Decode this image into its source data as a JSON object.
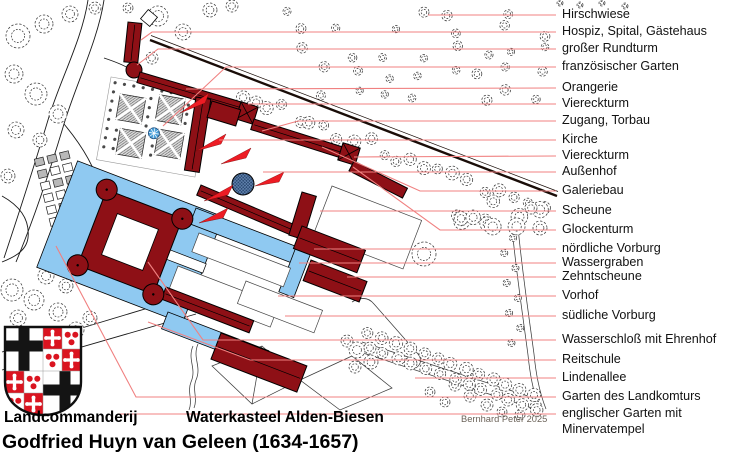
{
  "captions": {
    "left_label": "Landcommanderij",
    "center_label": "Waterkasteel Alden-Biesen",
    "main_title": "Godfried Huyn van Geleen (1634-1657)",
    "credit": "Bernhard Peter 2025"
  },
  "legend": {
    "items": [
      "Hirschwiese",
      "Hospiz, Spital, Gästehaus",
      "großer Rundturm",
      "französischer Garten",
      "Orangerie",
      "Viereckturm",
      "Zugang, Torbau",
      "Kirche",
      "Viereckturm",
      "Außenhof",
      "Galeriebau",
      "Scheune",
      "Glockenturm",
      "nördliche Vorburg",
      "Wassergraben",
      "Zehntscheune",
      "Vorhof",
      "südliche Vorburg",
      "Wasserschloß mit Ehrenhof",
      "Reitschule",
      "Lindenallee",
      "Garten des Landkomturs",
      "englischer Garten mit\nMinervatempel"
    ]
  },
  "colors": {
    "building": "#8e1016",
    "water": "#8fc9f1",
    "leader": "#f08080",
    "arrow": "#ed1c24",
    "fountain": "#4a9fd9",
    "shieldred": "#da1420",
    "wall": "#1a0d08",
    "credit": "#6b6258",
    "labeltext": "#121212"
  }
}
